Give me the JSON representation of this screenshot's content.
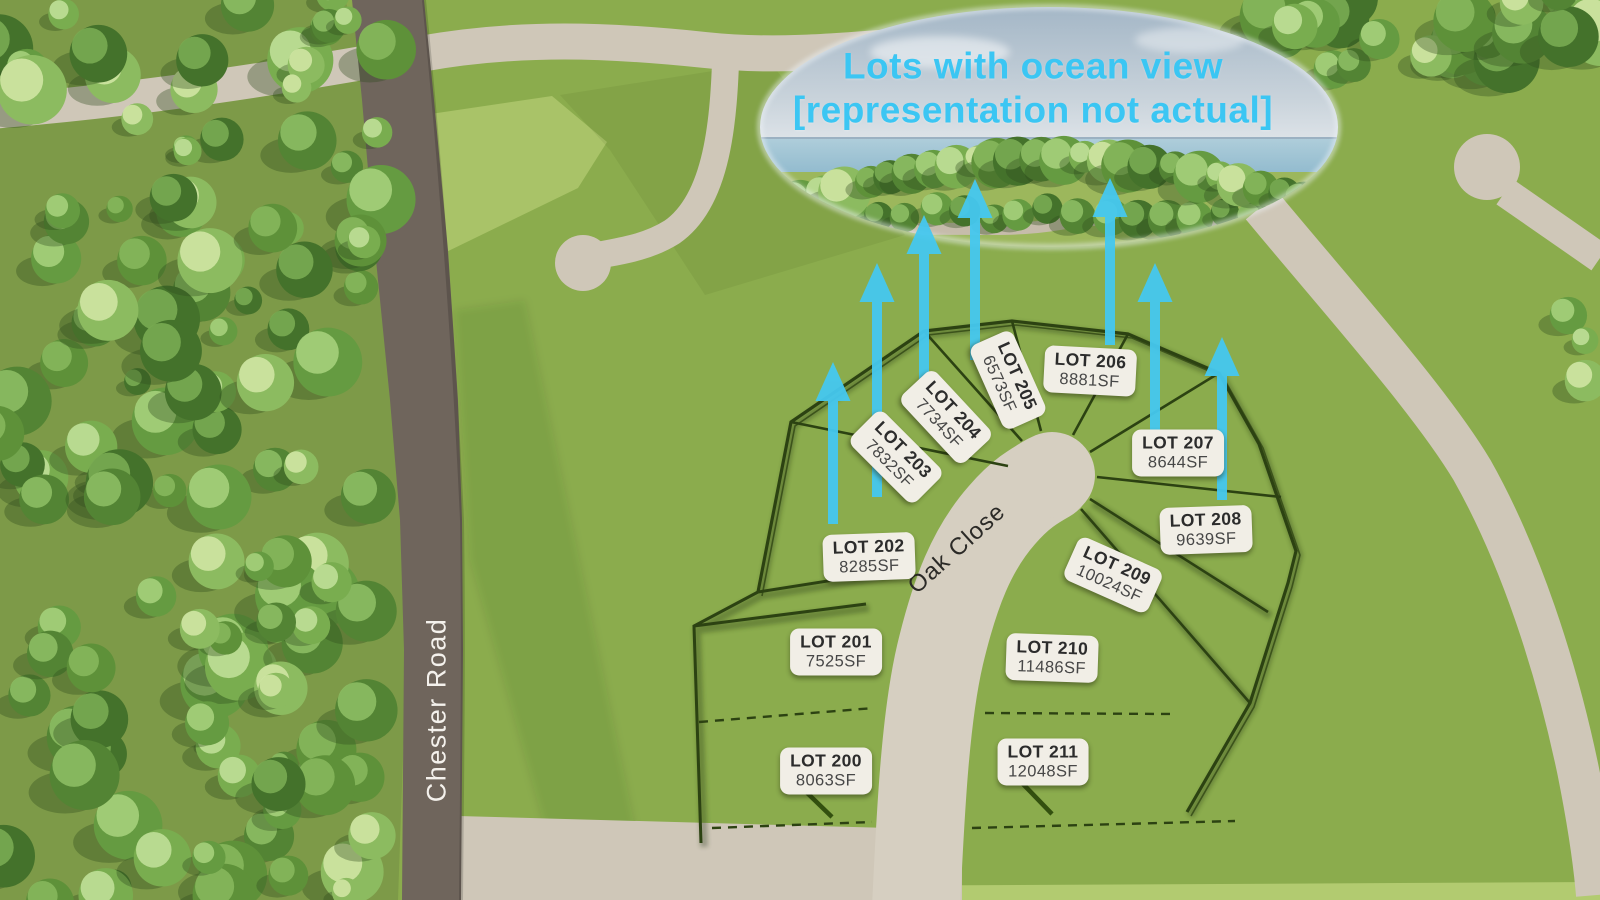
{
  "callout": {
    "line1": "Lots with ocean view",
    "line2": "[representation not actual]"
  },
  "streets": {
    "main_road": "Chester Road",
    "close": "Oak Close"
  },
  "lots": [
    {
      "name": "LOT 200",
      "area": "8063SF"
    },
    {
      "name": "LOT 201",
      "area": "7525SF"
    },
    {
      "name": "LOT 202",
      "area": "8285SF"
    },
    {
      "name": "LOT 203",
      "area": "7832SF"
    },
    {
      "name": "LOT 204",
      "area": "7734SF"
    },
    {
      "name": "LOT 205",
      "area": "6573SF"
    },
    {
      "name": "LOT 206",
      "area": "8881SF"
    },
    {
      "name": "LOT 207",
      "area": "8644SF"
    },
    {
      "name": "LOT 208",
      "area": "9639SF"
    },
    {
      "name": "LOT 209",
      "area": "10024SF"
    },
    {
      "name": "LOT 210",
      "area": "11486SF"
    },
    {
      "name": "LOT 211",
      "area": "12048SF"
    }
  ],
  "colors": {
    "accent_cyan": "#3bc6f3",
    "arrow_cyan": "#45c8f0",
    "field_green": "#8bac4d",
    "forest_green": "#7d9a48",
    "road_light": "#cfc7b8",
    "road_dark": "#6f655c",
    "lot_line_green": "#2c4212",
    "label_bg": "#f1eee6"
  }
}
